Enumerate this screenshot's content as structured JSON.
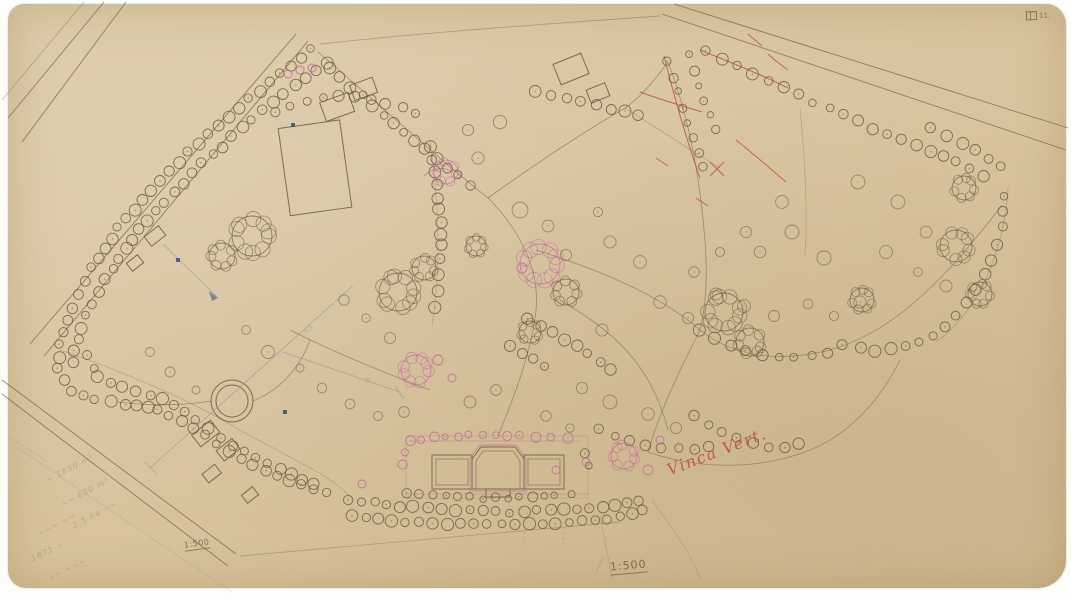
{
  "meta": {
    "description": "Hand-drawn park landscape plan on aged paper, scale 1:500"
  },
  "colors": {
    "paper": "#d9c6a2",
    "ink": "#6b5a41",
    "ink_light": "#8d7b5e",
    "pink": "#c2679c",
    "red": "#c14b3a",
    "blue": "#2f4f86",
    "pencil": "#8f836e",
    "measure": "#8b90a1"
  },
  "annotations": {
    "stamp": {
      "label": "11."
    },
    "scale_small": "1:500",
    "scale_main": "1:500",
    "red_note": "Vinca Vert.",
    "pencil_notes": [
      {
        "text": "~ 1850 m²",
        "x": 44,
        "y": 464,
        "rot": -28
      },
      {
        "text": "~~ 600 m²",
        "x": 58,
        "y": 488,
        "rot": -28
      },
      {
        "text": "2,5 ha ~~",
        "x": 70,
        "y": 510,
        "rot": -28
      },
      {
        "text": "~~~ ~~",
        "x": 36,
        "y": 520,
        "rot": -28
      },
      {
        "text": "1871 ~",
        "x": 30,
        "y": 547,
        "rot": -26
      },
      {
        "text": "~~ ~~~",
        "x": 46,
        "y": 565,
        "rot": -26
      }
    ],
    "measure_labels": [
      {
        "text": "4,5",
        "x": 306,
        "y": 334,
        "rot": -41
      },
      {
        "text": "6",
        "x": 365,
        "y": 382,
        "rot": 15
      }
    ]
  },
  "map": {
    "tree_rows": [
      {
        "name": "nw-outer",
        "color": "ink",
        "spacing": 13,
        "r": 5,
        "points": [
          [
            312,
            50
          ],
          [
            270,
            82
          ],
          [
            228,
            116
          ],
          [
            188,
            152
          ],
          [
            150,
            190
          ],
          [
            118,
            228
          ],
          [
            92,
            268
          ],
          [
            72,
            308
          ],
          [
            60,
            345
          ],
          [
            57,
            368
          ]
        ]
      },
      {
        "name": "nw-inner",
        "color": "ink",
        "spacing": 13,
        "r": 5,
        "points": [
          [
            326,
            62
          ],
          [
            284,
            94
          ],
          [
            242,
            128
          ],
          [
            202,
            164
          ],
          [
            164,
            202
          ],
          [
            132,
            240
          ],
          [
            106,
            278
          ],
          [
            86,
            316
          ],
          [
            74,
            350
          ],
          [
            70,
            372
          ]
        ]
      },
      {
        "name": "sw-outer",
        "color": "ink",
        "spacing": 13,
        "r": 5,
        "points": [
          [
            57,
            368
          ],
          [
            70,
            390
          ],
          [
            95,
            400
          ],
          [
            125,
            404
          ],
          [
            158,
            410
          ],
          [
            192,
            428
          ],
          [
            228,
            452
          ],
          [
            265,
            470
          ],
          [
            300,
            485
          ],
          [
            338,
            498
          ]
        ]
      },
      {
        "name": "sw-inner",
        "color": "ink",
        "spacing": 14,
        "r": 5,
        "points": [
          [
            88,
            356
          ],
          [
            98,
            378
          ],
          [
            122,
            388
          ],
          [
            152,
            394
          ],
          [
            184,
            412
          ],
          [
            220,
            438
          ],
          [
            256,
            458
          ],
          [
            292,
            474
          ],
          [
            325,
            488
          ]
        ]
      },
      {
        "name": "allee-south-1",
        "color": "ink",
        "spacing": 13,
        "r": 5,
        "points": [
          [
            348,
            500
          ],
          [
            400,
            506
          ],
          [
            455,
            510
          ],
          [
            510,
            512
          ],
          [
            565,
            510
          ],
          [
            615,
            505
          ],
          [
            652,
            497
          ]
        ]
      },
      {
        "name": "allee-south-2",
        "color": "ink",
        "spacing": 13,
        "r": 5,
        "points": [
          [
            352,
            515
          ],
          [
            405,
            521
          ],
          [
            460,
            524
          ],
          [
            515,
            525
          ],
          [
            570,
            523
          ],
          [
            620,
            517
          ],
          [
            655,
            508
          ]
        ]
      },
      {
        "name": "palace-top",
        "color": "pink",
        "spacing": 13,
        "r": 4,
        "points": [
          [
            410,
            440
          ],
          [
            445,
            437
          ],
          [
            482,
            435
          ],
          [
            520,
            435
          ],
          [
            552,
            437
          ],
          [
            582,
            441
          ]
        ]
      },
      {
        "name": "palace-bottom",
        "color": "ink",
        "spacing": 13,
        "r": 4,
        "points": [
          [
            408,
            493
          ],
          [
            445,
            496
          ],
          [
            482,
            498
          ],
          [
            520,
            498
          ],
          [
            555,
            496
          ],
          [
            586,
            492
          ]
        ]
      },
      {
        "name": "palace-left",
        "color": "pink",
        "spacing": 12,
        "r": 4,
        "points": [
          [
            404,
            452
          ],
          [
            402,
            466
          ],
          [
            404,
            480
          ]
        ]
      },
      {
        "name": "palace-right",
        "color": "ink",
        "spacing": 12,
        "r": 4,
        "points": [
          [
            586,
            452
          ],
          [
            589,
            466
          ],
          [
            587,
            480
          ]
        ]
      },
      {
        "name": "meadow-east",
        "color": "ink",
        "spacing": 14,
        "r": 5,
        "points": [
          [
            430,
            148
          ],
          [
            436,
            185
          ],
          [
            440,
            222
          ],
          [
            441,
            258
          ],
          [
            438,
            292
          ],
          [
            431,
            322
          ]
        ]
      },
      {
        "name": "diagonal-path",
        "color": "ink",
        "spacing": 14,
        "r": 5,
        "points": [
          [
            330,
            68
          ],
          [
            362,
            96
          ],
          [
            394,
            124
          ],
          [
            426,
            150
          ],
          [
            458,
            176
          ],
          [
            484,
            196
          ]
        ]
      },
      {
        "name": "meadow-north",
        "color": "ink",
        "spacing": 15,
        "r": 5,
        "points": [
          [
            276,
            112
          ],
          [
            306,
            101
          ],
          [
            338,
            96
          ],
          [
            370,
            100
          ],
          [
            402,
            108
          ],
          [
            428,
            120
          ]
        ]
      },
      {
        "name": "ne-road",
        "color": "ink",
        "spacing": 15,
        "r": 5,
        "points": [
          [
            706,
            52
          ],
          [
            752,
            74
          ],
          [
            798,
            95
          ],
          [
            844,
            115
          ],
          [
            888,
            134
          ],
          [
            930,
            152
          ],
          [
            968,
            168
          ],
          [
            1000,
            183
          ]
        ]
      },
      {
        "name": "ne-corner",
        "color": "ink",
        "spacing": 16,
        "r": 5,
        "points": [
          [
            930,
            128
          ],
          [
            962,
            142
          ],
          [
            990,
            158
          ],
          [
            1012,
            176
          ]
        ]
      },
      {
        "name": "east-boundary",
        "color": "ink",
        "spacing": 14,
        "r": 5,
        "points": [
          [
            1005,
            195
          ],
          [
            1002,
            228
          ],
          [
            992,
            260
          ],
          [
            976,
            290
          ],
          [
            956,
            316
          ],
          [
            932,
            336
          ],
          [
            905,
            347
          ],
          [
            876,
            350
          ],
          [
            848,
            346
          ]
        ]
      },
      {
        "name": "east-path",
        "color": "ink",
        "spacing": 15,
        "r": 5,
        "points": [
          [
            700,
            330
          ],
          [
            730,
            345
          ],
          [
            762,
            355
          ],
          [
            795,
            358
          ],
          [
            828,
            352
          ],
          [
            858,
            340
          ]
        ]
      },
      {
        "name": "south-east-row",
        "color": "ink",
        "spacing": 14,
        "r": 5,
        "points": [
          [
            600,
            430
          ],
          [
            630,
            440
          ],
          [
            662,
            448
          ],
          [
            694,
            450
          ],
          [
            724,
            444
          ]
        ]
      },
      {
        "name": "center-1",
        "color": "ink",
        "spacing": 13,
        "r": 5,
        "points": [
          [
            528,
            318
          ],
          [
            552,
            332
          ],
          [
            576,
            346
          ],
          [
            600,
            362
          ],
          [
            622,
            378
          ]
        ]
      },
      {
        "name": "center-2",
        "color": "ink",
        "spacing": 13,
        "r": 5,
        "points": [
          [
            510,
            345
          ],
          [
            534,
            360
          ],
          [
            556,
            375
          ]
        ]
      },
      {
        "name": "ne-inner-1",
        "color": "ink",
        "spacing": 14,
        "r": 4,
        "points": [
          [
            668,
            62
          ],
          [
            678,
            92
          ],
          [
            688,
            122
          ],
          [
            698,
            152
          ],
          [
            706,
            180
          ]
        ]
      },
      {
        "name": "ne-inner-2",
        "color": "ink",
        "spacing": 14,
        "r": 4,
        "points": [
          [
            690,
            55
          ],
          [
            700,
            85
          ],
          [
            710,
            115
          ],
          [
            720,
            145
          ]
        ]
      },
      {
        "name": "top-center",
        "color": "ink",
        "spacing": 15,
        "r": 5,
        "points": [
          [
            536,
            90
          ],
          [
            566,
            98
          ],
          [
            596,
            106
          ],
          [
            626,
            112
          ],
          [
            652,
            116
          ]
        ]
      },
      {
        "name": "se-lower",
        "color": "ink",
        "spacing": 15,
        "r": 5,
        "points": [
          [
            694,
            416
          ],
          [
            722,
            432
          ],
          [
            752,
            444
          ],
          [
            784,
            448
          ],
          [
            814,
            442
          ]
        ]
      }
    ],
    "clusters": [
      [
        252,
        236,
        20,
        "ink"
      ],
      [
        222,
        256,
        13,
        "ink"
      ],
      [
        398,
        292,
        19,
        "ink"
      ],
      [
        424,
        268,
        12,
        "ink"
      ],
      [
        416,
        370,
        15,
        "pink"
      ],
      [
        540,
        264,
        20,
        "pink"
      ],
      [
        566,
        292,
        13,
        "ink"
      ],
      [
        446,
        172,
        12,
        "pink"
      ],
      [
        724,
        312,
        19,
        "ink"
      ],
      [
        750,
        342,
        14,
        "ink"
      ],
      [
        956,
        246,
        16,
        "ink"
      ],
      [
        980,
        294,
        12,
        "ink"
      ],
      [
        862,
        300,
        12,
        "ink"
      ],
      [
        624,
        456,
        13,
        "pink"
      ],
      [
        530,
        332,
        11,
        "ink"
      ],
      [
        476,
        246,
        10,
        "ink"
      ],
      [
        964,
        188,
        12,
        "ink"
      ]
    ],
    "single_trees": [
      [
        468,
        130,
        7
      ],
      [
        500,
        122,
        6
      ],
      [
        478,
        158,
        6
      ],
      [
        520,
        210,
        7
      ],
      [
        548,
        226,
        6
      ],
      [
        566,
        255,
        6
      ],
      [
        598,
        212,
        5
      ],
      [
        610,
        242,
        7
      ],
      [
        640,
        262,
        6
      ],
      [
        660,
        302,
        7
      ],
      [
        688,
        318,
        6
      ],
      [
        602,
        330,
        6
      ],
      [
        582,
        388,
        6
      ],
      [
        610,
        402,
        6
      ],
      [
        648,
        414,
        6
      ],
      [
        676,
        428,
        5
      ],
      [
        760,
        252,
        7
      ],
      [
        792,
        232,
        6
      ],
      [
        824,
        258,
        6
      ],
      [
        782,
        202,
        6
      ],
      [
        858,
        182,
        6
      ],
      [
        898,
        202,
        6
      ],
      [
        926,
        232,
        6
      ],
      [
        886,
        252,
        6
      ],
      [
        918,
        272,
        5
      ],
      [
        946,
        286,
        6
      ],
      [
        860,
        302,
        6
      ],
      [
        834,
        316,
        5
      ],
      [
        808,
        304,
        5
      ],
      [
        774,
        316,
        6
      ],
      [
        744,
        306,
        6
      ],
      [
        716,
        294,
        6
      ],
      [
        694,
        272,
        5
      ],
      [
        720,
        252,
        5
      ],
      [
        746,
        232,
        5
      ],
      [
        390,
        338,
        6
      ],
      [
        366,
        318,
        5
      ],
      [
        344,
        300,
        5
      ],
      [
        268,
        352,
        6
      ],
      [
        246,
        330,
        5
      ],
      [
        300,
        368,
        5
      ],
      [
        322,
        388,
        5
      ],
      [
        350,
        404,
        5
      ],
      [
        378,
        416,
        5
      ],
      [
        404,
        412,
        5
      ],
      [
        470,
        402,
        5
      ],
      [
        496,
        390,
        5
      ],
      [
        546,
        416,
        5
      ],
      [
        570,
        428,
        5
      ],
      [
        150,
        352,
        5
      ],
      [
        170,
        372,
        5
      ],
      [
        196,
        390,
        5
      ]
    ],
    "pink_trees": [
      [
        288,
        74,
        4
      ],
      [
        300,
        70,
        4
      ],
      [
        312,
        68,
        4
      ],
      [
        362,
        484,
        4
      ],
      [
        648,
        470,
        5
      ],
      [
        660,
        440,
        4
      ],
      [
        522,
        268,
        5
      ],
      [
        438,
        360,
        5
      ],
      [
        452,
        378,
        4
      ],
      [
        556,
        470,
        4
      ],
      [
        586,
        462,
        4
      ]
    ],
    "blue_squares": [
      [
        176,
        258
      ],
      [
        283,
        410
      ],
      [
        291,
        123
      ]
    ]
  }
}
